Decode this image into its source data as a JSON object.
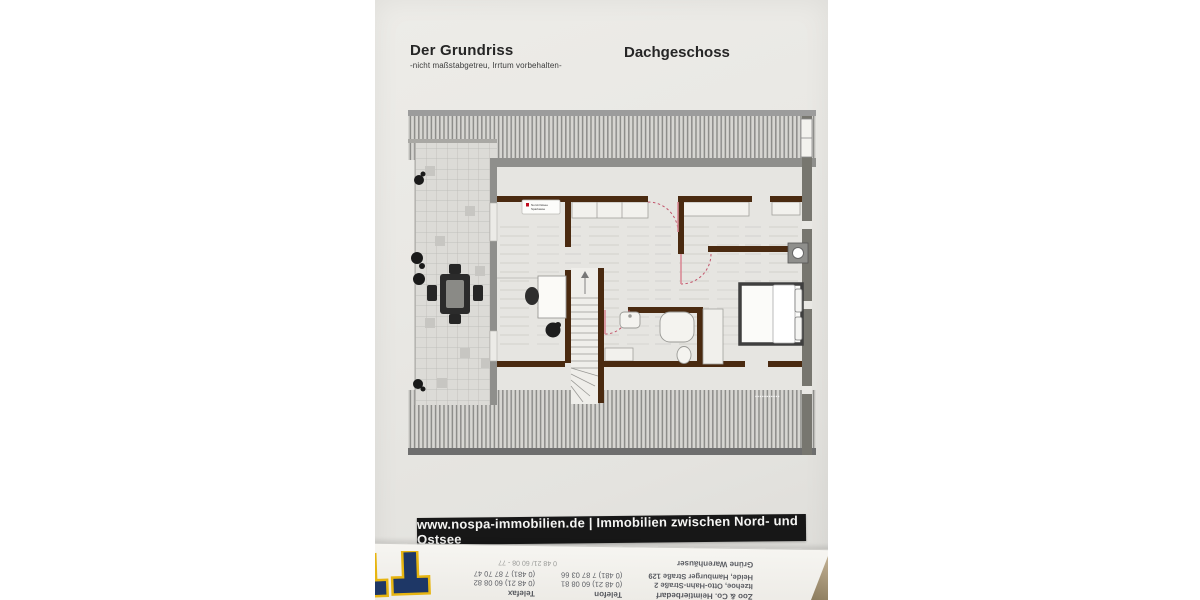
{
  "header": {
    "title": "Der Grundriss",
    "subtitle": "-nicht maßstabgetreu, Irrtum vorbehalten-",
    "floor_label": "Dachgeschoss"
  },
  "plan": {
    "logo_line1": "Nord-Ostsee",
    "logo_line2": "Sparkasse",
    "watermark": "▪▪▪▪▪▪▪▪▪▪▪",
    "colors": {
      "wall_brown": "#4a2a10",
      "wall_gray": "#8f8f8c",
      "door_swing_red": "#c2556b",
      "paper": "#e9e8e4",
      "hatch_line": "#8d8d8a"
    }
  },
  "banner": {
    "text": "www.nospa-immobilien.de | Immobilien zwischen Nord- und Ostsee",
    "background": "#171717"
  },
  "reverse_sheet": {
    "company": "Zoo & Co. Heimtierbedarf",
    "address1": "Itzehoe, Otto-Hahn-Straße 2",
    "address2": "Heide, Hamburger Straße 129",
    "phone_label": "Telefon",
    "phone1": "(0 48 21) 60 08 81",
    "phone2": "(0 481) 7 87 03 66",
    "fax_label": "Telefax",
    "fax1": "(0 48 21) 60 08 82",
    "fax2": "(0 481) 7 87 70 47",
    "tagline": "Grüne Warenhäuser",
    "partial_line": "0 48 21/ 60 08 - 77",
    "logo_colors": {
      "navy": "#1e3766",
      "yellow": "#e7b511"
    }
  }
}
